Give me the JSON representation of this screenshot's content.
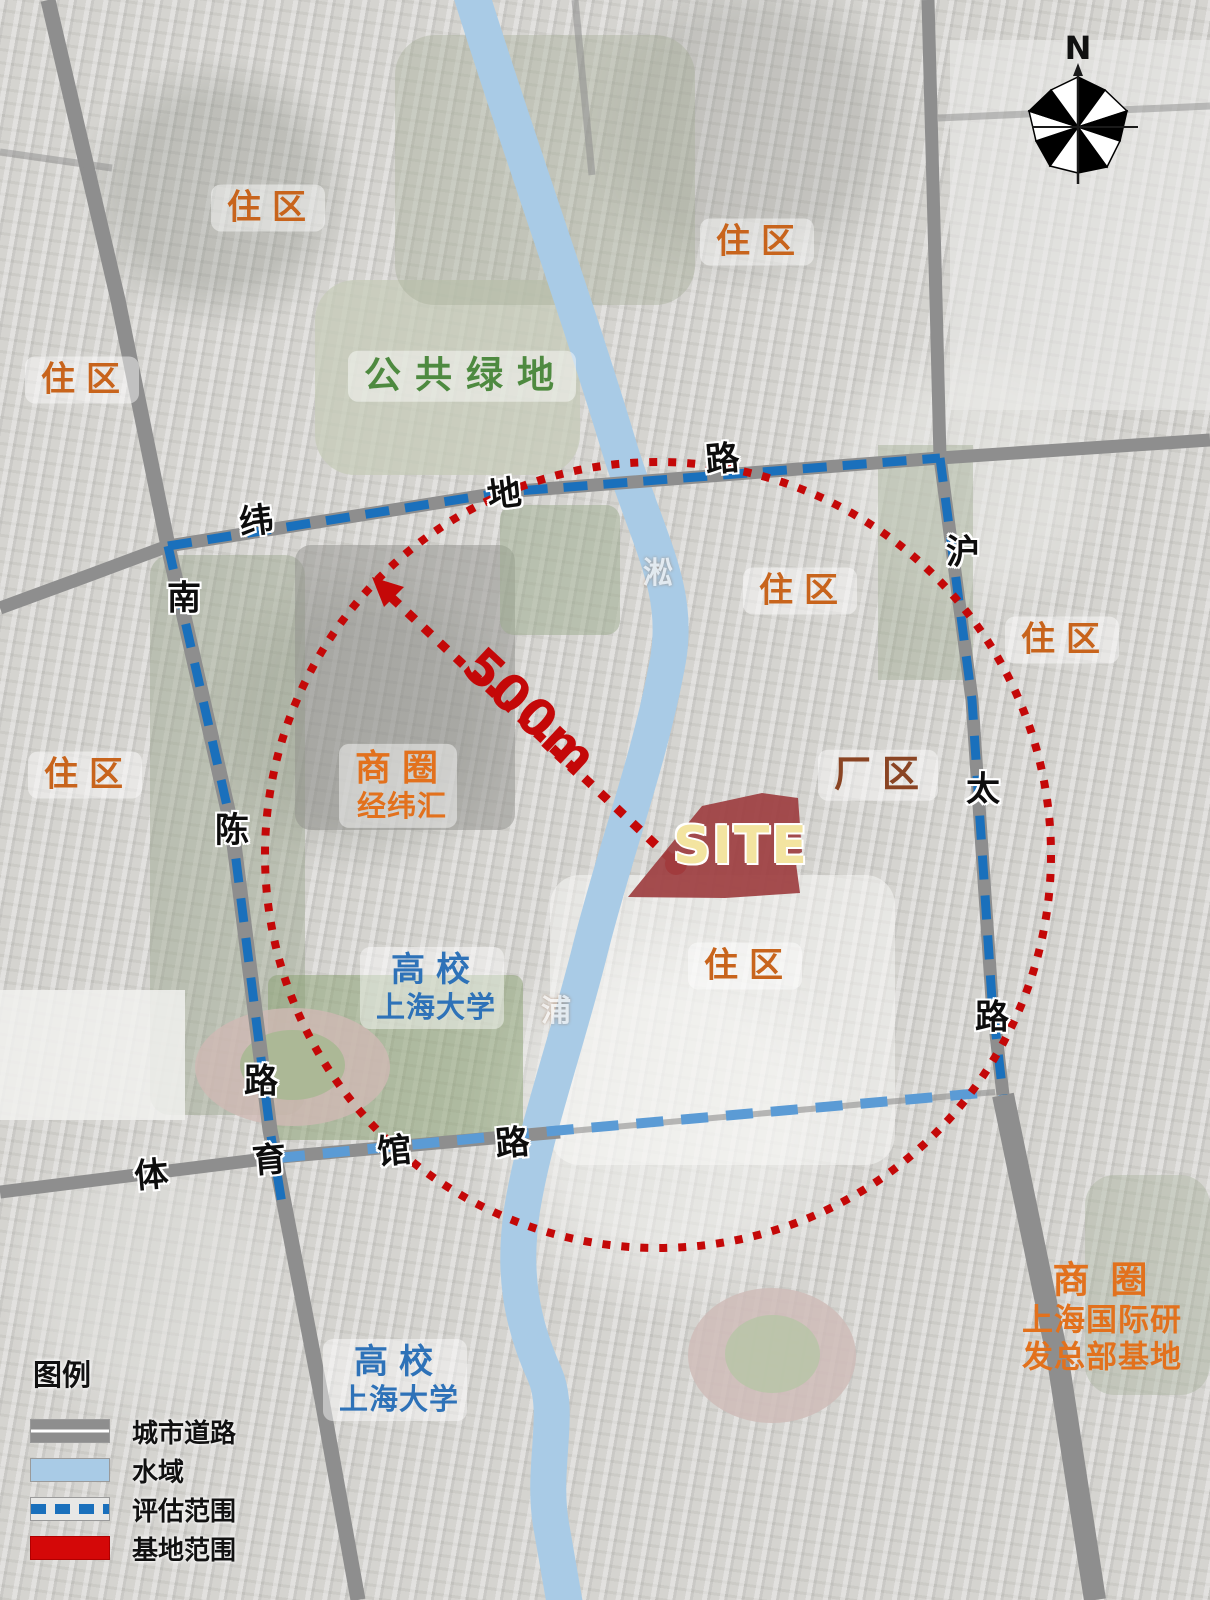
{
  "compass": {
    "north_label": "N"
  },
  "site_marker": {
    "label": "SITE",
    "fill": "#9e4042",
    "text_color": "#f3e4a0"
  },
  "radius_annotation": {
    "label": "500m",
    "color": "#c40808",
    "radius_px": 393
  },
  "area_labels": [
    {
      "id": "residential-top-left",
      "label": "住区",
      "color": "#c8641c"
    },
    {
      "id": "residential-top-right",
      "label": "住区",
      "color": "#c8641c"
    },
    {
      "id": "residential-left",
      "label": "住区",
      "color": "#c8641c"
    },
    {
      "id": "public-green-space",
      "label": "公共绿地",
      "color": "#4e8a40"
    },
    {
      "id": "residential-center",
      "label": "住区",
      "color": "#c8641c"
    },
    {
      "id": "residential-right",
      "label": "住区",
      "color": "#c8641c"
    },
    {
      "id": "residential-mid-left",
      "label": "住区",
      "color": "#c8641c"
    },
    {
      "id": "business-district-jingweihui",
      "label": "商圈",
      "sublabel": "经纬汇",
      "color": "#e2711d"
    },
    {
      "id": "factory-district",
      "label": "厂区",
      "color": "#8a4423"
    },
    {
      "id": "university-north",
      "label": "高校",
      "sublabel": "上海大学",
      "color": "#2e72b8"
    },
    {
      "id": "residential-bottom-center",
      "label": "住区",
      "color": "#c8641c"
    },
    {
      "id": "university-south",
      "label": "高校",
      "sublabel": "上海大学",
      "color": "#2e72b8"
    },
    {
      "id": "business-district-hub",
      "label": "商 圈",
      "sub1": "上海国际研",
      "sub2": "发总部基地",
      "color": "#e2711d"
    }
  ],
  "road_labels": [
    {
      "id": "weidi-road-char-1",
      "char": "纬"
    },
    {
      "id": "weidi-road-char-2",
      "char": "地"
    },
    {
      "id": "weidi-road-char-3",
      "char": "路"
    },
    {
      "id": "hutai-road-char-1",
      "char": "沪"
    },
    {
      "id": "hutai-road-char-2",
      "char": "太"
    },
    {
      "id": "hutai-road-char-3",
      "char": "路"
    },
    {
      "id": "nanchen-road-char-1",
      "char": "南"
    },
    {
      "id": "nanchen-road-char-2",
      "char": "陈"
    },
    {
      "id": "nanchen-road-char-3",
      "char": "路"
    },
    {
      "id": "tiyuguan-road-char-1",
      "char": "体"
    },
    {
      "id": "tiyuguan-road-char-2",
      "char": "育"
    },
    {
      "id": "tiyuguan-road-char-3",
      "char": "馆"
    },
    {
      "id": "tiyuguan-road-char-4",
      "char": "路"
    }
  ],
  "river_labels": [
    {
      "id": "river-name-upper",
      "char": "淞"
    },
    {
      "id": "river-name-lower",
      "char": "浦"
    }
  ],
  "legend": {
    "title": "图例",
    "items": [
      {
        "label": "城市道路",
        "swatch": "road"
      },
      {
        "label": "水域",
        "swatch": "water"
      },
      {
        "label": "评估范围",
        "swatch": "eval-dash"
      },
      {
        "label": "基地范围",
        "swatch": "site-red"
      }
    ]
  },
  "colors": {
    "road_gray": "#8e8e8e",
    "water_blue": "#a9cbe6",
    "evaluation_blue": "#1a70bc",
    "evaluation_light_blue": "#5b9bd5",
    "circle_red": "#c40808",
    "site_maroon": "#9e4042"
  }
}
